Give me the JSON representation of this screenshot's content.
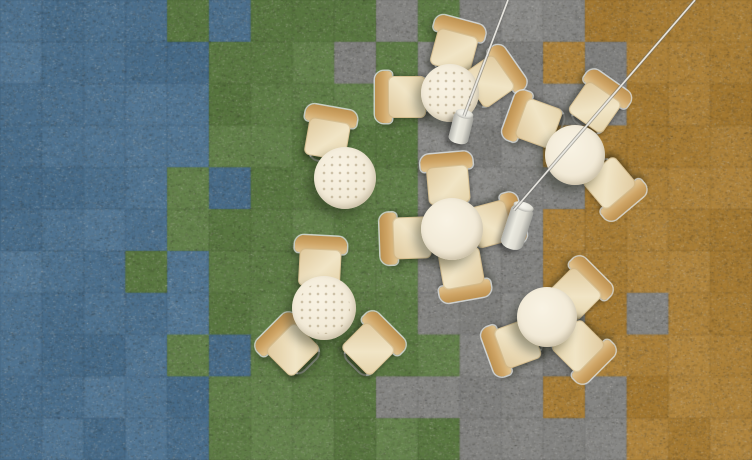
{
  "scene": {
    "width": 752,
    "height": 460,
    "label": "overhead-view-cafe-seating-on-multicolor-carpet-tiles"
  },
  "carpet": {
    "cols": 18,
    "rows": 11,
    "palette": {
      "B": "#4e7290",
      "G": "#5f7d46",
      "Y": "#868684",
      "O": "#ab8038"
    },
    "grid": [
      "BBBBGBGGGYGYYYOOOO",
      "BBBBBGGGYGYYYOYOOO",
      "BBBBBGGGGGYYYYYOOO",
      "BBBBBGGGGGYYYOOOOO",
      "BBBBGBGGGGYYYYOOOO",
      "BBBBGGGGGGYYYOOOOO",
      "BBBGBGGGGGYYYOOOOO",
      "BBBBBGGGGGYYYYOYOO",
      "BBBBGBGGGGGYYYOOOO",
      "BBBBBGGGGYYYYOYOOO",
      "BBBBBGGGGGGYYYYOOO"
    ],
    "seam_alpha": 0.06,
    "speckle_colors": [
      "#26261f",
      "#e0ddd6",
      "#8c8c86",
      "#5a5349"
    ]
  },
  "furniture": {
    "tables": [
      {
        "x": 450,
        "y": 93,
        "r": 29,
        "dotted": true
      },
      {
        "x": 345,
        "y": 178,
        "r": 31,
        "dotted": true
      },
      {
        "x": 575,
        "y": 155,
        "r": 30,
        "dotted": false
      },
      {
        "x": 452,
        "y": 229,
        "r": 31,
        "dotted": false
      },
      {
        "x": 324,
        "y": 308,
        "r": 32,
        "dotted": true
      },
      {
        "x": 547,
        "y": 317,
        "r": 30,
        "dotted": false
      }
    ],
    "chairs": [
      {
        "x": 455,
        "y": 47,
        "rot": 15
      },
      {
        "x": 403,
        "y": 97,
        "rot": 270
      },
      {
        "x": 492,
        "y": 79,
        "rot": 55
      },
      {
        "x": 328,
        "y": 135,
        "rot": 10
      },
      {
        "x": 597,
        "y": 104,
        "rot": 35
      },
      {
        "x": 535,
        "y": 122,
        "rot": 290
      },
      {
        "x": 612,
        "y": 186,
        "rot": 140
      },
      {
        "x": 448,
        "y": 181,
        "rot": 355
      },
      {
        "x": 408,
        "y": 238,
        "rot": 268
      },
      {
        "x": 495,
        "y": 223,
        "rot": 75
      },
      {
        "x": 462,
        "y": 272,
        "rot": 170
      },
      {
        "x": 320,
        "y": 264,
        "rot": 3
      },
      {
        "x": 290,
        "y": 347,
        "rot": 315
      },
      {
        "x": 371,
        "y": 346,
        "rot": 45
      },
      {
        "x": 578,
        "y": 291,
        "rot": 45
      },
      {
        "x": 514,
        "y": 345,
        "rot": 250
      },
      {
        "x": 581,
        "y": 349,
        "rot": 135
      }
    ],
    "lamps": [
      {
        "x": 461,
        "y": 128,
        "w": 20,
        "h": 32,
        "rot": 14
      },
      {
        "x": 517,
        "y": 227,
        "w": 23,
        "h": 46,
        "rot": 18
      }
    ],
    "cords": [
      {
        "x1": 508,
        "y1": 0,
        "x2": 464,
        "y2": 116
      },
      {
        "x1": 695,
        "y1": 0,
        "x2": 514,
        "y2": 210
      }
    ]
  },
  "colors": {
    "table_top": "#f2ebd9",
    "chair_wood": "#c89c5a",
    "chair_seat": "#efe2c2",
    "metal": "#c6c9c6",
    "lamp_body": "#dddbd1",
    "cord_light": "#eceae4",
    "cord_dark": "#6e6e6a"
  }
}
